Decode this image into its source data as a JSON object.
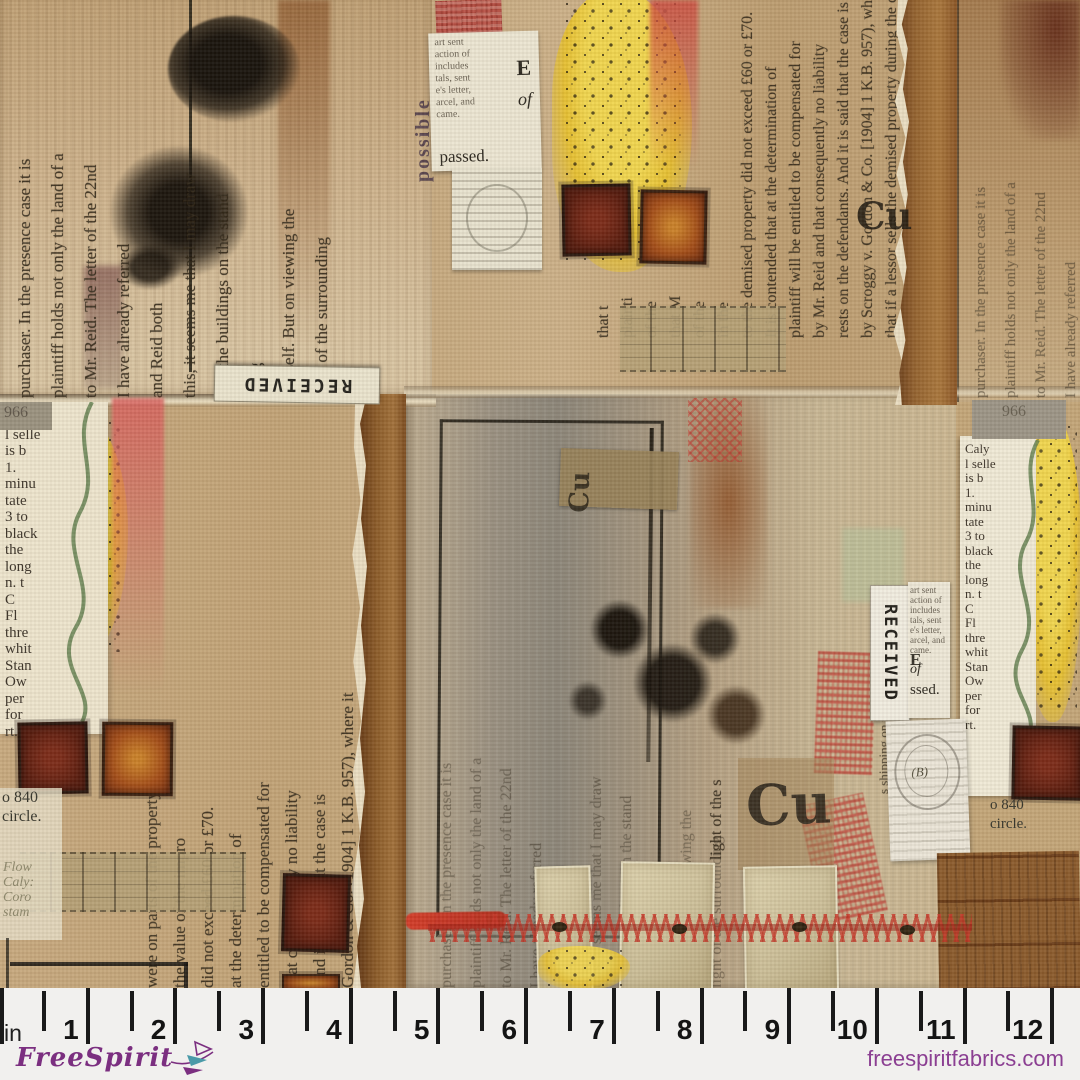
{
  "fabric": {
    "labels": {
      "received": "RECEIVED",
      "cu": "Cu",
      "passed": "passed.",
      "e": "E",
      "of": "of",
      "ssed": "ssed.",
      "possible": "possible",
      "postmark_b": "(B)",
      "num966": "966"
    },
    "strips": {
      "buildings": "s shipping on the buildings",
      "light": "light of the s"
    },
    "text": {
      "left": [
        "purchaser. In the presence case it is",
        "plaintiff holds not only the land of a",
        "to Mr. Reid. The letter of the 22nd",
        "I have already referred",
        "and Reid both",
        "this, it seems me that I may draw",
        "that the buildings on the stand",
        "say g",
        "himself. But on viewing the",
        "light of the surrounding"
      ],
      "center": [
        "that t",
        "plainti",
        "of the",
        "that M",
        "of the",
        "in the",
        "to the demised property did not exceed £60 or £70.",
        "It is contended that at the determination of",
        "plaintiff will be entitled to be compensated for",
        "by Mr. Reid and that consequently no liability",
        "rests on the defendants. And it is said that the case is",
        "by Scroggy v. Gordon & Co. [1904] 1 K.B. 957), where it",
        "that if a lessor sells the demised property during the co"
      ],
      "mid": [
        "were on parts of the property not",
        "the value of the impro",
        "did not exceed £60 or £70.",
        "at the determination of",
        "entitled to be compensated for",
        "that consequently no liability",
        "And it is said that the case is",
        "Gordon & Co. [1904] 1 K.B. 957), where it",
        "sells the demised property during the co"
      ]
    },
    "dictionary": [
      "Caly",
      "l selle",
      "is b",
      "1.",
      "minu",
      "tate",
      "3 to",
      "black",
      "the",
      "long",
      "n. t",
      "C",
      "Fl",
      "thre",
      "whit",
      "Stan",
      "Ow",
      "per",
      "for",
      "rt."
    ],
    "flower": [
      "Flow",
      "Caly:",
      "Coro",
      "stam"
    ],
    "o840": [
      "o 840",
      "circle."
    ],
    "scrap": [
      "art sent",
      "action of",
      "includes",
      "tals, sent",
      "e's letter,",
      "arcel, and",
      "came."
    ]
  },
  "ruler": {
    "unit": "in",
    "numbers": [
      "1",
      "2",
      "3",
      "4",
      "5",
      "6",
      "7",
      "8",
      "9",
      "10",
      "11",
      "12"
    ]
  },
  "footer": {
    "brand": "FreeSpirit",
    "website": "freespiritfabrics.com"
  },
  "colors": {
    "brand_purple": "#7b2f80",
    "website_purple": "#8b3f92",
    "ruler_background": "#f1f0ee",
    "tick_black": "#1a1a1a",
    "base_tan": "#c3a47c",
    "paper_cream": "#ece4cd",
    "paint_yellow": "#e9c73e",
    "paint_red": "#c9463c",
    "ink_black": "#1d1812",
    "kraft_brown": "#8a5a2c",
    "maroon_square": "#5c1d10",
    "orange_square": "#b05a20",
    "stitch_red": "#c0392b",
    "vine_green": "#5c7a49"
  }
}
